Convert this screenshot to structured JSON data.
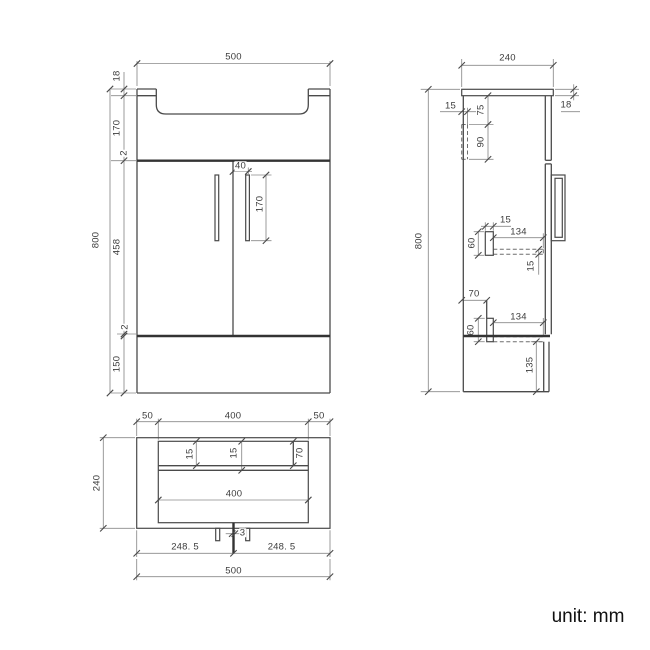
{
  "title": "vanity unit technical drawing",
  "unit_label": "unit: mm",
  "views": {
    "front": {
      "label": "front view",
      "dims": {
        "width": "500",
        "top_thickness": "18",
        "basin_height": "170",
        "gap_top": "2",
        "door_height": "458",
        "gap_bottom": "2",
        "plinth_height": "150",
        "overall_height": "800",
        "handle_offset": "40",
        "handle_length": "170"
      }
    },
    "side": {
      "label": "side view",
      "dims": {
        "depth": "240",
        "top_thickness": "18",
        "rail_width": "15",
        "rail_offset": "75",
        "rail_height": "90",
        "overall_height": "800",
        "shelf_support_width": "15",
        "shelf_depth": "134",
        "shelf_support_height": "60",
        "shelf_thickness": "15",
        "bottom_offset": "70",
        "bottom_depth": "134",
        "bottom_support_height": "60",
        "plinth_height": "135"
      }
    },
    "plan": {
      "label": "plan view",
      "dims": {
        "overhang_left": "50",
        "top_width": "400",
        "overhang_right": "50",
        "depth": "240",
        "back_inset": "15",
        "panel_thickness": "15",
        "corner_depth": "70",
        "bowl_width": "400",
        "waste_gap": "3",
        "left_half": "248. 5",
        "right_half": "248. 5",
        "total_width": "500"
      }
    }
  }
}
